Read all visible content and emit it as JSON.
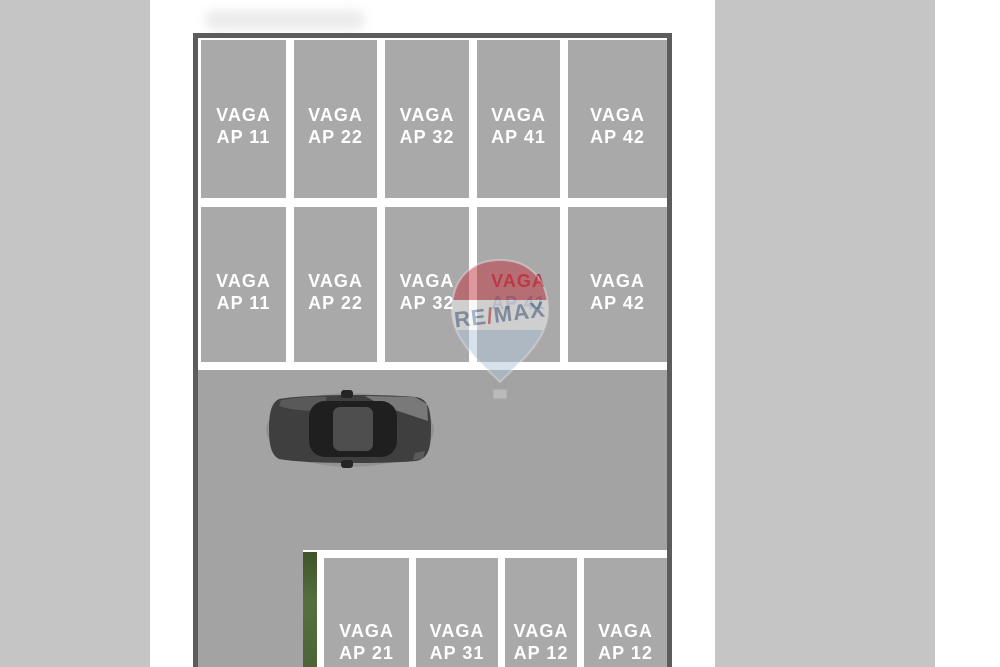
{
  "colors": {
    "bars": "#c5c5c5",
    "lane": "#a3a3a3",
    "stall": "#a9a9a9",
    "line": "#ffffff",
    "border": "#5c5c5c",
    "hedge": "#55703e",
    "red": "#c23a46",
    "blue": "#b3c6d9",
    "band": "#f2f2f2",
    "letter": "#5a7092",
    "accent1": "#b23945",
    "accent2": "#75839c",
    "car_body": "#3f3f3f",
    "car_glass": "#1f1f1f"
  },
  "lot": {
    "rows": {
      "top": [
        {
          "l1": "VAGA",
          "l2": "AP 11"
        },
        {
          "l1": "VAGA",
          "l2": "AP 22"
        },
        {
          "l1": "VAGA",
          "l2": "AP 32"
        },
        {
          "l1": "VAGA",
          "l2": "AP 41"
        },
        {
          "l1": "VAGA",
          "l2": "AP 42"
        }
      ],
      "middle": [
        {
          "l1": "VAGA",
          "l2": "AP 11"
        },
        {
          "l1": "VAGA",
          "l2": "AP 22"
        },
        {
          "l1": "VAGA",
          "l2": "AP 32"
        },
        {
          "l1": "VAGA",
          "l2": "AP 41"
        },
        {
          "l1": "VAGA",
          "l2": "AP 42"
        }
      ],
      "bottom": [
        {
          "l1": "VAGA",
          "l2": "AP 21"
        },
        {
          "l1": "VAGA",
          "l2": "AP 31"
        },
        {
          "l1": "VAGA",
          "l2": "AP 12"
        },
        {
          "l1": "VAGA",
          "l2": "AP 12"
        }
      ]
    }
  },
  "watermark": {
    "re": "RE",
    "slash": "/",
    "max": "MAX"
  }
}
